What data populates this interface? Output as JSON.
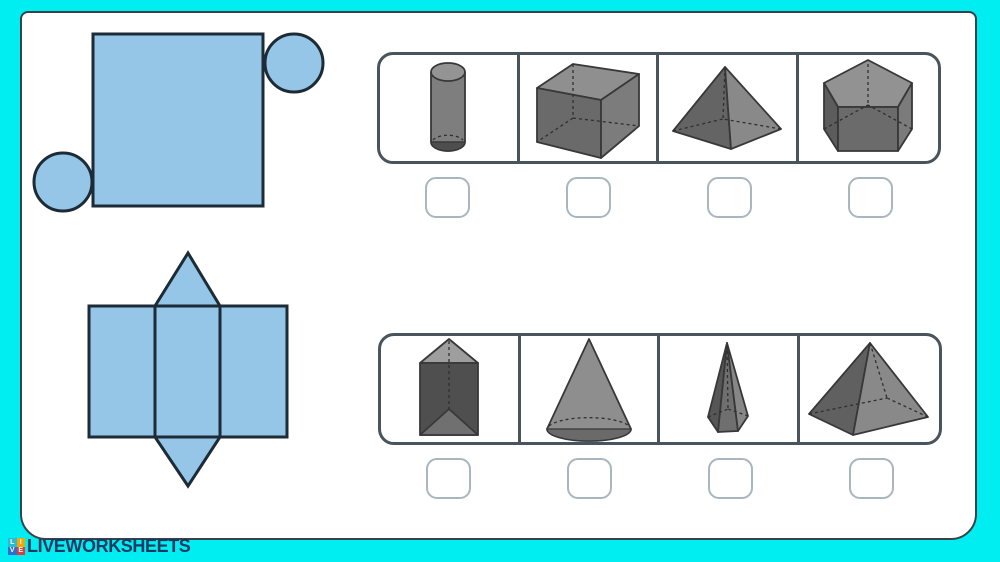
{
  "app": {
    "name": "match-nets-to-3d-shapes-worksheet"
  },
  "logo": {
    "text": "LIVEWORKSHEETS",
    "icon_letters": [
      "L",
      "I",
      "V",
      "E"
    ],
    "icon_colors": [
      "#2bbcd4",
      "#f7a600",
      "#2f6fd0",
      "#e23c39"
    ],
    "text_color": "#1a3a61"
  },
  "colors": {
    "frame": "#00eef2",
    "page_background": "#ffffff",
    "page_border": "#39424a",
    "net_fill": "#95c6e8",
    "net_stroke": "#1c2b36",
    "option_box_border": "#49545c",
    "checkbox_border": "#a9b6be",
    "shape_dark": "#5a5a5a",
    "shape_mid": "#7a7a7a",
    "shape_light": "#929292"
  },
  "questions": [
    {
      "id": 1,
      "net": {
        "name": "net-square-with-two-circles",
        "label": "blue net: large square with a circle at the top-right and a circle at the bottom-left"
      },
      "options": [
        {
          "name": "cylinder",
          "label": "cylinder"
        },
        {
          "name": "cube",
          "label": "cube"
        },
        {
          "name": "square-pyramid",
          "label": "square pyramid"
        },
        {
          "name": "pentagonal-prism",
          "label": "pentagonal prism"
        }
      ],
      "answers": [
        {
          "checked": false
        },
        {
          "checked": false
        },
        {
          "checked": false
        },
        {
          "checked": false
        }
      ]
    },
    {
      "id": 2,
      "net": {
        "name": "net-triangular-prism",
        "label": "blue net: three rectangles side by side with a triangle above and below the middle rectangle"
      },
      "options": [
        {
          "name": "triangular-prism",
          "label": "triangular prism"
        },
        {
          "name": "cone",
          "label": "cone"
        },
        {
          "name": "pentagonal-pyramid",
          "label": "pentagonal pyramid"
        },
        {
          "name": "square-pyramid-wide",
          "label": "square pyramid"
        }
      ],
      "answers": [
        {
          "checked": false
        },
        {
          "checked": false
        },
        {
          "checked": false
        },
        {
          "checked": false
        }
      ]
    }
  ]
}
